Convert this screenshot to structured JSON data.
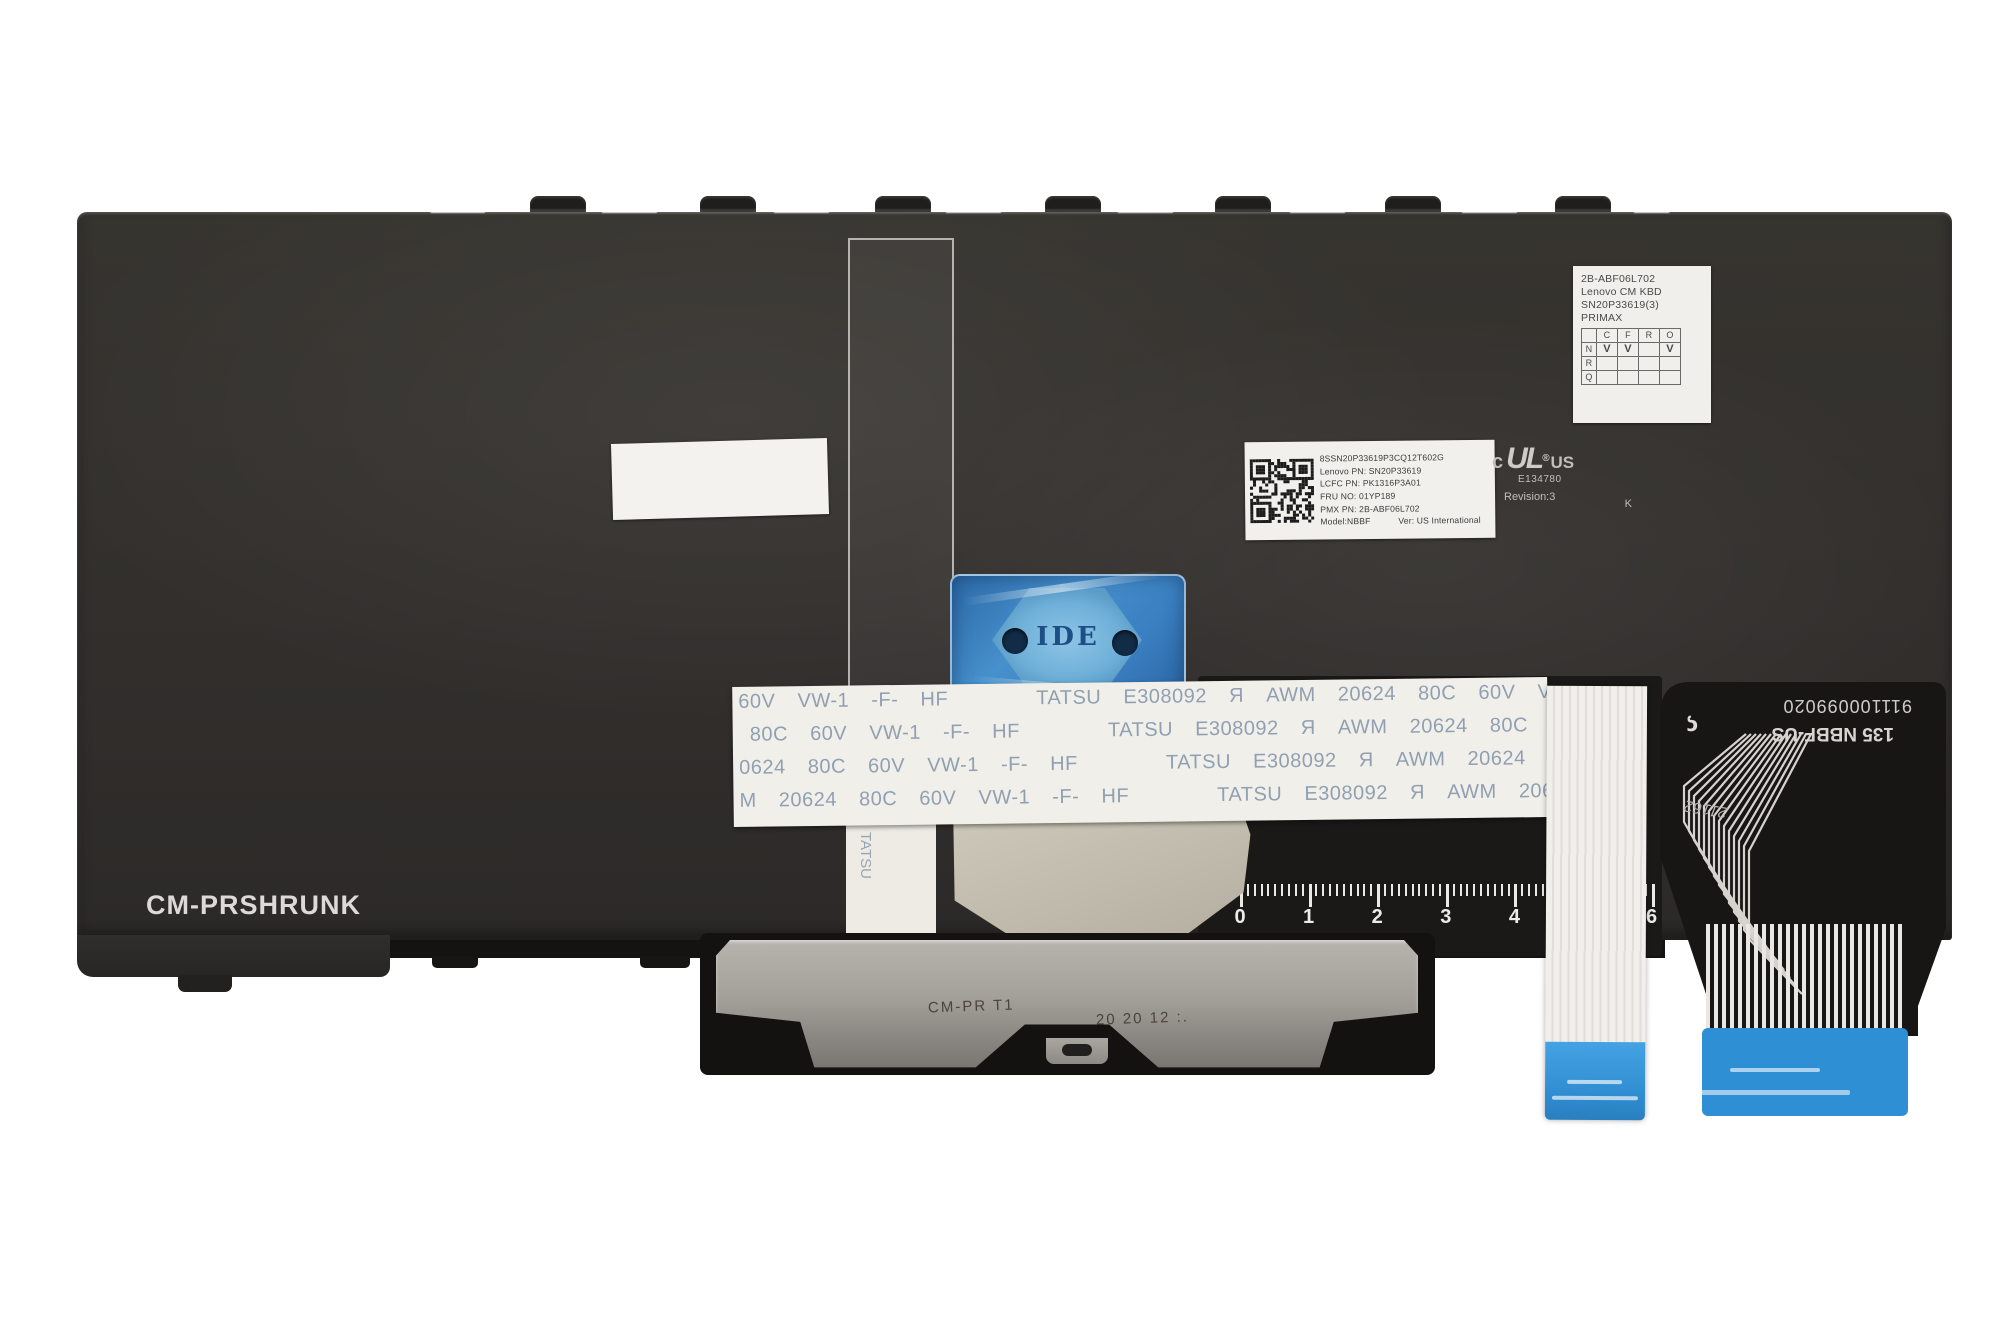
{
  "title": "Lenovo CM KBD keyboard backplate (rear view)",
  "colors": {
    "plate": "#312f2d",
    "label_white": "#f1f0ec",
    "blue_sticker": "#4690cc",
    "cable_blue": "#3b9bdf",
    "bracket_silver": "#a8a5a0",
    "pad_red": "#7c403c",
    "ribbon_text": "#8597ac"
  },
  "plate": {
    "bottom_left_marking": "CM-PRSHRUNK"
  },
  "primax_label": {
    "line1": "2B-ABF06L702",
    "line2": "Lenovo CM KBD",
    "line3": "SN20P33619(3)",
    "line4": "PRIMAX",
    "table": {
      "header": [
        "",
        "C",
        "F",
        "R",
        "O"
      ],
      "rows": [
        [
          "N",
          "V",
          "V",
          "",
          "V"
        ],
        [
          "R",
          "",
          "",
          "",
          ""
        ],
        [
          "Q",
          "",
          "",
          "",
          ""
        ]
      ]
    }
  },
  "qr_label": {
    "line1": "8SSN20P33619P3CQ12T602G",
    "line2": "Lenovo PN: SN20P33619",
    "line3": "LCFC PN: PK1316P3A01",
    "line4": "FRU NO: 01YP189",
    "line5": "PMX PN: 2B-ABF06L702",
    "line6_model": "Model:NBBF",
    "line6_ver": "Ver: US International"
  },
  "ul_mark": {
    "c": "c",
    "ul": "UL",
    "reg": "®",
    "us": "US",
    "file": "E134780",
    "k": "K",
    "revision": "Revision:3"
  },
  "ribbon": {
    "rows": [
      "60V  VW-1  -F-  HF        TATSU  E308092  Я  AWM  20624  80C  60V  VW-1  -F-  HF        TATSU  E3",
      " 80C  60V  VW-1  -F-  HF        TATSU  E308092  Я  AWM  20624  80C  60V  VW-1  -F-  HF        TATS",
      "0624  80C  60V  VW-1  -F-  HF        TATSU  E308092  Я  AWM  20624  80C  60V  VW-1  -F-  HF      ",
      "M  20624  80C  60V  VW-1  -F-  HF        TATSU  E308092  Я  AWM  20624  80C  60V  VW-1  -F-  HF"
    ],
    "tail_text": "TATSU"
  },
  "blue_sticker": {
    "text": "IDE"
  },
  "ruler": {
    "units": [
      "0",
      "1",
      "2",
      "3",
      "4",
      "5",
      "6"
    ]
  },
  "flex_right": {
    "part_number": "911100099020",
    "model": "135 NBBF-US",
    "handwritten": "21162",
    "logo": "ς"
  },
  "bracket": {
    "stamp_left": "CM-PR T1",
    "stamp_right": "20 20 12 :.",
    "holes": [
      [
        740,
        962,
        9
      ],
      [
        838,
        960,
        10
      ],
      [
        926,
        962,
        9
      ],
      [
        1016,
        958,
        8
      ],
      [
        1092,
        962,
        9
      ],
      [
        1190,
        960,
        9
      ],
      [
        1286,
        962,
        10
      ],
      [
        1398,
        962,
        9
      ],
      [
        735,
        1032,
        10
      ],
      [
        792,
        1040,
        9
      ],
      [
        930,
        1046,
        10
      ],
      [
        1004,
        1022,
        7
      ],
      [
        1108,
        1026,
        7
      ],
      [
        1168,
        1022,
        9
      ],
      [
        1326,
        1030,
        10
      ],
      [
        1404,
        1028,
        9
      ],
      [
        779,
        1006,
        20
      ],
      [
        779,
        1006,
        8
      ]
    ],
    "pads": [
      [
        755,
        946
      ],
      [
        775,
        946
      ],
      [
        795,
        946
      ],
      [
        849,
        944
      ],
      [
        869,
        944
      ],
      [
        889,
        944
      ],
      [
        947,
        946
      ],
      [
        967,
        946
      ],
      [
        987,
        946
      ],
      [
        1157,
        944
      ],
      [
        1177,
        944
      ],
      [
        1197,
        944
      ],
      [
        1365,
        946
      ],
      [
        1385,
        946
      ],
      [
        1405,
        946
      ],
      [
        800,
        1016
      ],
      [
        903,
        1018
      ],
      [
        748,
        1036
      ]
    ],
    "slots": [
      [
        1008,
        978
      ],
      [
        1198,
        978
      ]
    ]
  },
  "callouts": [
    {
      "n": "1",
      "x": 1001,
      "y": 524
    },
    {
      "n": "2",
      "x": 948,
      "y": 921
    },
    {
      "n": "3",
      "x": 812,
      "y": 282
    },
    {
      "n": "4",
      "x": 1430,
      "y": 550
    },
    {
      "n": "5",
      "x": 1641,
      "y": 526
    },
    {
      "n": "6",
      "x": 1513,
      "y": 858
    },
    {
      "n": "7",
      "x": 1537,
      "y": 288
    },
    {
      "n": "8",
      "x": 408,
      "y": 522
    },
    {
      "n": "9",
      "x": 425,
      "y": 905
    },
    {
      "n": "10",
      "x": 342,
      "y": 280
    }
  ],
  "plus_marks": [
    [
      106,
      227
    ],
    [
      306,
      223
    ],
    [
      527,
      225
    ],
    [
      760,
      227
    ],
    [
      900,
      225
    ],
    [
      1109,
      222
    ],
    [
      1262,
      226
    ],
    [
      1435,
      227
    ],
    [
      1619,
      227
    ],
    [
      1839,
      227
    ],
    [
      96,
      302
    ],
    [
      355,
      308
    ],
    [
      676,
      300
    ],
    [
      822,
      316
    ],
    [
      1255,
      301
    ],
    [
      1360,
      302
    ],
    [
      1549,
      303
    ],
    [
      1718,
      302
    ],
    [
      1880,
      300
    ],
    [
      236,
      421
    ],
    [
      600,
      424
    ],
    [
      830,
      420
    ],
    [
      1100,
      422
    ],
    [
      1225,
      422
    ],
    [
      1345,
      422
    ],
    [
      1620,
      420
    ],
    [
      1900,
      421
    ],
    [
      117,
      533
    ],
    [
      430,
      545
    ],
    [
      677,
      537
    ],
    [
      1016,
      548
    ],
    [
      1210,
      537
    ],
    [
      1447,
      572
    ],
    [
      1655,
      549
    ],
    [
      1900,
      540
    ],
    [
      102,
      663
    ],
    [
      334,
      671
    ],
    [
      572,
      665
    ],
    [
      808,
      668
    ],
    [
      1180,
      663
    ],
    [
      1588,
      665
    ],
    [
      108,
      791
    ],
    [
      478,
      797
    ],
    [
      714,
      794
    ],
    [
      1900,
      795
    ],
    [
      88,
      963
    ],
    [
      222,
      963
    ],
    [
      344,
      963
    ],
    [
      437,
      926
    ],
    [
      567,
      925
    ],
    [
      790,
      928
    ],
    [
      930,
      932
    ],
    [
      1128,
      928
    ],
    [
      1508,
      892
    ]
  ],
  "dots": [
    [
      421,
      519
    ],
    [
      829,
      663
    ],
    [
      1347,
      541
    ],
    [
      1530,
      545
    ],
    [
      486,
      795
    ],
    [
      1262,
      664
    ],
    [
      640,
      302
    ],
    [
      1119,
      302
    ]
  ],
  "ovals": [
    [
      181,
      287
    ],
    [
      181,
      403
    ],
    [
      1133,
      413
    ],
    [
      1748,
      287
    ],
    [
      1747,
      404
    ]
  ],
  "hooks": [
    530,
    700,
    875,
    1045,
    1215,
    1385,
    1555
  ],
  "lips": [
    [
      390,
      330
    ],
    [
      1420,
      245
    ]
  ],
  "lip_tabs": [
    [
      432,
      46
    ],
    [
      640,
      50
    ]
  ]
}
